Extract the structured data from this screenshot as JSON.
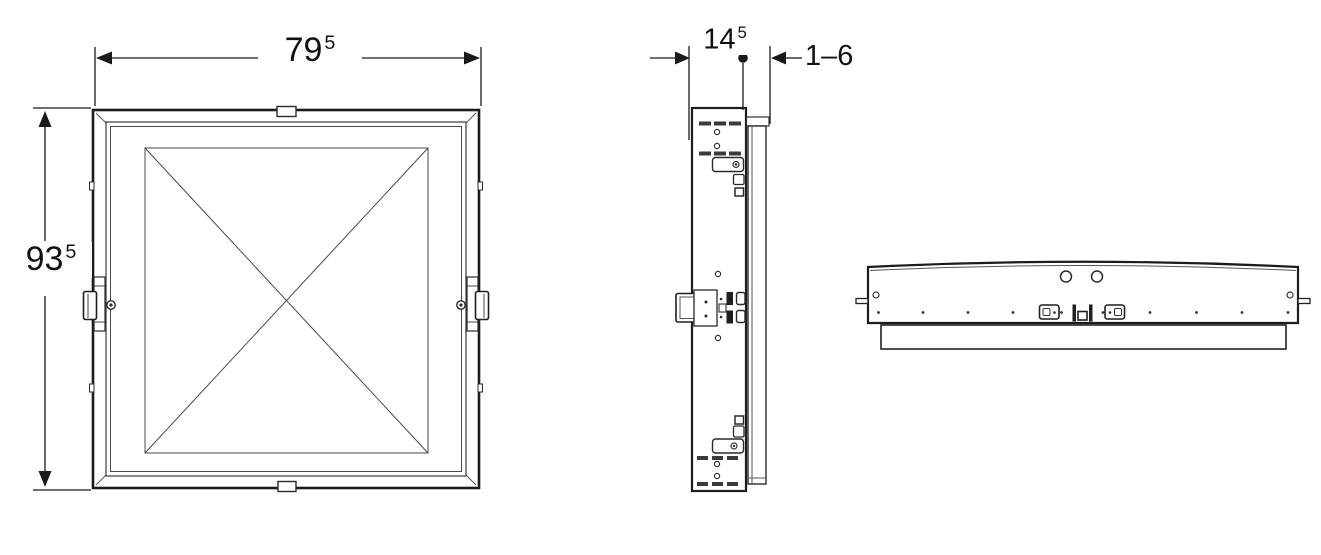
{
  "labels": {
    "width": {
      "main": "79",
      "sup": "5"
    },
    "height": {
      "main": "93",
      "sup": "5"
    },
    "depth": {
      "main": "14",
      "sup": "5"
    },
    "range": "1–6"
  },
  "colors": {
    "outline": "#1c1c1c",
    "thin_line": "#4a4a4a",
    "dimension": "#1a1a1a",
    "background": "#ffffff"
  }
}
